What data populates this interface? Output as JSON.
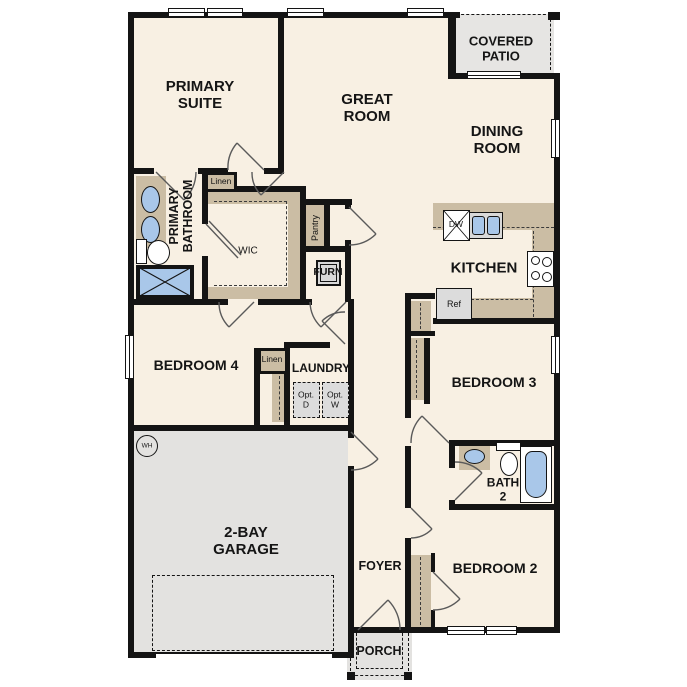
{
  "plan_title": "single-story floor plan",
  "labels": {
    "covered_patio": "COVERED\nPATIO",
    "primary_suite": "PRIMARY\nSUITE",
    "great_room": "GREAT\nROOM",
    "dining_room": "DINING\nROOM",
    "kitchen": "KITCHEN",
    "primary_bathroom": "PRIMARY\nBATHROOM",
    "linen_bath": "Linen",
    "wic": "WIC",
    "pantry": "Pantry",
    "furn": "FURN",
    "bedroom_4": "BEDROOM 4",
    "linen_hall": "Linen",
    "laundry": "LAUNDRY",
    "opt_d": "Opt.\nD",
    "opt_w": "Opt.\nW",
    "ref": "Ref",
    "dw": "DW",
    "bedroom_3": "BEDROOM 3",
    "bath_2": "BATH\n2",
    "bedroom_2": "BEDROOM 2",
    "foyer": "FOYER",
    "porch": "PORCH",
    "garage": "2-BAY\nGARAGE",
    "wh": "WH"
  },
  "colors": {
    "floor": "#f8f0e3",
    "wall": "#141414",
    "cabinetry_tan": "#cbbda4",
    "concrete_gray": "#e3e2e0",
    "patio_gray": "#e6e5e3",
    "appliance_gray": "#dcdcdc",
    "fixture_blue": "#a9c7e9",
    "door_arc": "#5a5a5a"
  }
}
